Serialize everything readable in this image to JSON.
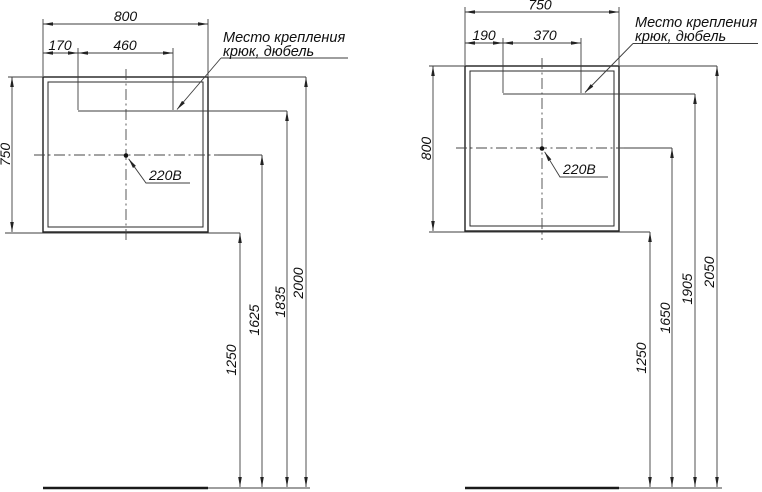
{
  "figures": [
    {
      "name": "mirror-mounting-scheme-800x750",
      "top_width": "800",
      "hook_offset": "170",
      "hook_spacing": "460",
      "side_height": "750",
      "mount_note": [
        "Место крепления",
        "крюк, дюбель"
      ],
      "power_label": "220В",
      "floor_heights": {
        "mirror_bottom": "1250",
        "outlet": "1625",
        "hook": "1835",
        "mirror_top": "2000"
      }
    },
    {
      "name": "mirror-mounting-scheme-750x800",
      "top_width": "750",
      "hook_offset": "190",
      "hook_spacing": "370",
      "side_height": "800",
      "mount_note": [
        "Место крепления",
        "крюк, дюбель"
      ],
      "power_label": "220В",
      "floor_heights": {
        "mirror_bottom": "1250",
        "outlet": "1650",
        "hook": "1905",
        "mirror_top": "2050"
      }
    }
  ]
}
